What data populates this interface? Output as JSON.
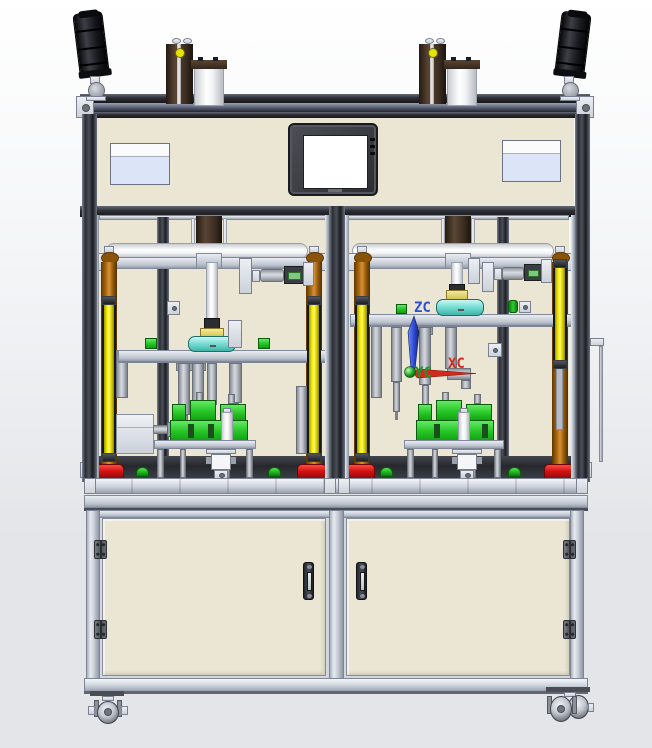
{
  "csys": {
    "z": "ZC",
    "x": "XC",
    "y": "YC"
  },
  "colors": {
    "bg-top": "#ffffff",
    "bg-bottom": "#e3e5e8",
    "beige": "#eae6d3",
    "frame-dark": "#26282e",
    "alu-mid": "#c3c9d4",
    "brown": "#4e3b2c",
    "orange": "#b9741a",
    "yellow": "#f0e800",
    "red": "#d31212",
    "green": "#24c324",
    "cyan": "#7adfd6",
    "screen": "#ffffff",
    "bezel": "#3a3b40",
    "label-blue": "#dce4f7",
    "tower-black": "#141519",
    "csys-z": "#2a4fd6",
    "csys-x": "#d42a1e",
    "csys-y": "#0d9e2a"
  }
}
